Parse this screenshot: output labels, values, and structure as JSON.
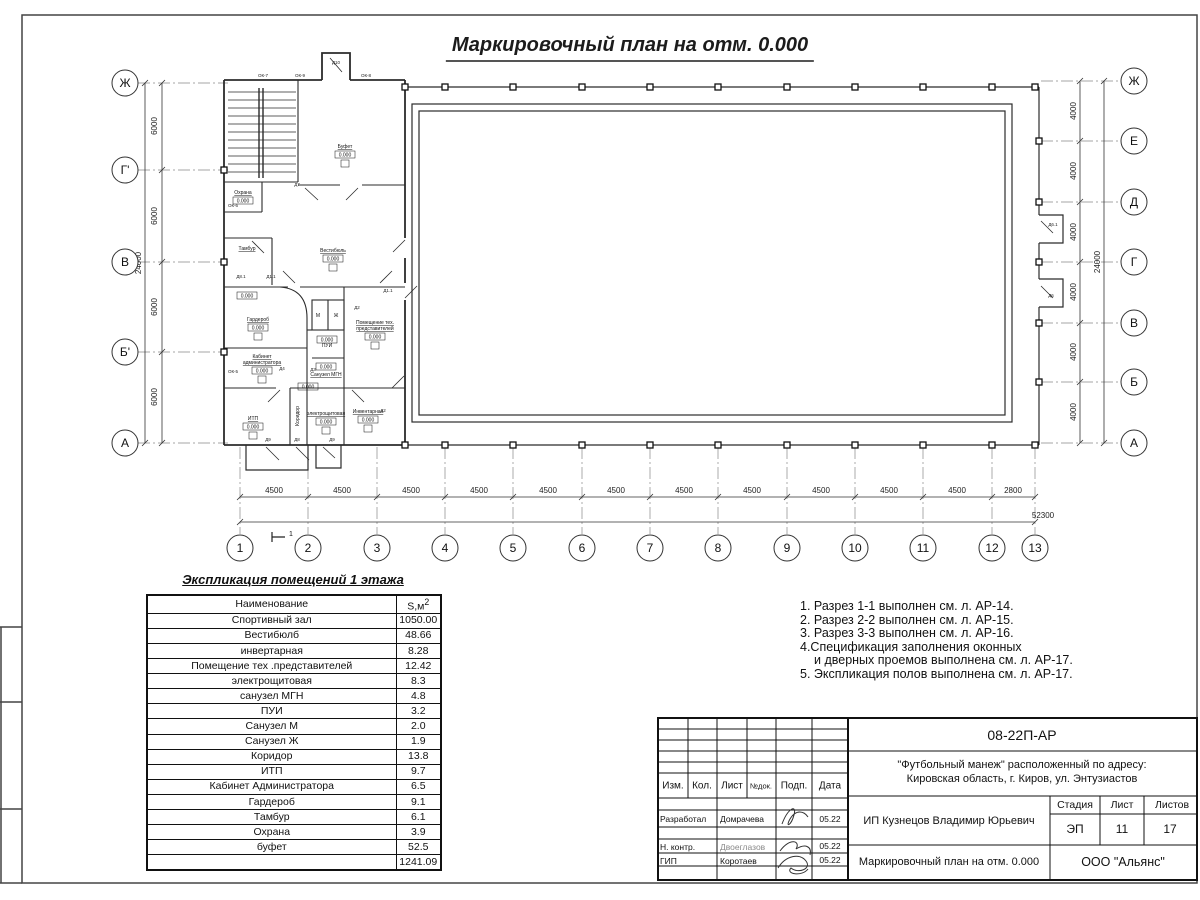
{
  "page": {
    "title": "Маркировочный план на отм. 0.000"
  },
  "plan": {
    "axes_left": [
      "Ж",
      "Г'",
      "В",
      "Б'",
      "А"
    ],
    "axes_right": [
      "Ж",
      "Е",
      "Д",
      "Г",
      "В",
      "Б",
      "А"
    ],
    "axes_bottom": [
      "1",
      "2",
      "3",
      "4",
      "5",
      "6",
      "7",
      "8",
      "9",
      "10",
      "11",
      "12",
      "13"
    ],
    "dims_bottom": [
      "4500",
      "4500",
      "4500",
      "4500",
      "4500",
      "4500",
      "4500",
      "4500",
      "4500",
      "4500",
      "4500",
      "2800"
    ],
    "dim_total_bottom": "52300",
    "dims_left": [
      "6000",
      "6000",
      "6000",
      "6000"
    ],
    "dim_total_left": "24000",
    "dims_right": [
      "4000",
      "4000",
      "4000",
      "4000",
      "4000",
      "4000"
    ],
    "dim_total_right": "24000",
    "elevation": "0.000",
    "section_mark": "1",
    "rooms": {
      "bufet": "Буфет",
      "vestibul": "Вестибюль",
      "tambur": "Тамбур",
      "ohrana": "Охрана",
      "garderob": "Гардероб",
      "kabinet_l1": "Кабинет",
      "kabinet_l2": "администратора",
      "itp": "ИТП",
      "koridor": "Коридор",
      "pui": "ПУИ",
      "su_mgn": "Санузел МГН",
      "pomteh_l1": "Помещение тех.",
      "pomteh_l2": "представителей",
      "elektro": "электрощитовая",
      "inventar": "Инвентарная",
      "su_m": "М",
      "su_zh": "Ж"
    },
    "tags": [
      "ОК-7",
      "ОК-9",
      "Д10",
      "ОК-8",
      "ОК-6",
      "ОК-5",
      "Д7",
      "Д8.1",
      "Д1.1",
      "Д1.1",
      "Д4",
      "Д2",
      "Д3",
      "Д2",
      "Д9",
      "Д8",
      "Д9",
      "Д6.1",
      "Д6"
    ]
  },
  "explication": {
    "title": "Экспликация помещений 1 этажа",
    "col_name": "Наименование",
    "col_area_base": "S,м",
    "col_area_sup": "2",
    "rows": [
      {
        "name": "Спортивный зал",
        "area": "1050.00"
      },
      {
        "name": "Вестибюлб",
        "area": "48.66"
      },
      {
        "name": "инвертарная",
        "area": "8.28"
      },
      {
        "name": "Помещение тех .представителей",
        "area": "12.42"
      },
      {
        "name": "электрощитовая",
        "area": "8.3"
      },
      {
        "name": "санузел МГН",
        "area": "4.8"
      },
      {
        "name": "ПУИ",
        "area": "3.2"
      },
      {
        "name": "Санузел М",
        "area": "2.0"
      },
      {
        "name": "Санузел Ж",
        "area": "1.9"
      },
      {
        "name": "Коридор",
        "area": "13.8"
      },
      {
        "name": "ИТП",
        "area": "9.7"
      },
      {
        "name": "Кабинет Администратора",
        "area": "6.5"
      },
      {
        "name": "Гардероб",
        "area": "9.1"
      },
      {
        "name": "Тамбур",
        "area": "6.1"
      },
      {
        "name": "Охрана",
        "area": "3.9"
      },
      {
        "name": "буфет",
        "area": "52.5"
      }
    ],
    "total": "1241.09"
  },
  "notes": [
    "1. Разрез 1-1 выполнен см. л. АР-14.",
    "2. Разрез 2-2 выполнен см. л. АР-15.",
    "3. Разрез 3-3 выполнен см. л. АР-16.",
    "4.Спецификация заполнения оконных",
    "и дверных проемов выполнена см. л. АР-17.",
    "5. Экспликация полов выполнена см. л. АР-17."
  ],
  "title_block": {
    "code": "08-22П-АР",
    "address_line1": "\"Футбольный манеж\" расположенный по адресу:",
    "address_line2": "Кировская область, г. Киров, ул. Энтузиастов",
    "client": "ИП Кузнецов Владимир Юрьевич",
    "drawing_name": "Маркировочный план на отм. 0.000",
    "company": "ООО \"Альянс\"",
    "stage_label": "Стадия",
    "sheet_label": "Лист",
    "sheets_label": "Листов",
    "stage": "ЭП",
    "sheet": "11",
    "sheets": "17",
    "cols": {
      "izm": "Изм.",
      "kol": "Кол.",
      "list": "Лист",
      "ndok": "№док.",
      "podp": "Подп.",
      "data": "Дата"
    },
    "roles": [
      {
        "role": "Разработал",
        "name": "Домрачева",
        "date": "05.22"
      },
      {
        "role": "Н. контр.",
        "name": "Двоеглазов",
        "date": "05.22"
      },
      {
        "role": "ГИП",
        "name": "Коротаев",
        "date": "05.22"
      }
    ]
  }
}
